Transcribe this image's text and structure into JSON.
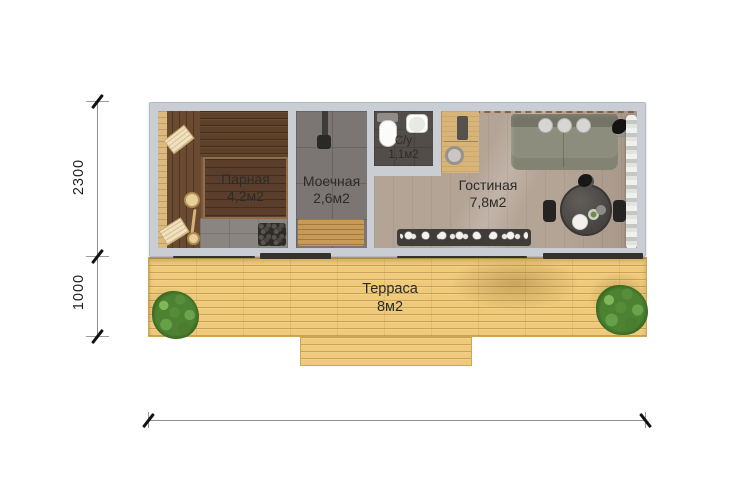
{
  "plan": {
    "title": "Floor plan of sauna house with terrace",
    "rooms": [
      {
        "id": "parnaya",
        "name": "Парная",
        "area": "4,2м2"
      },
      {
        "id": "moechnaya",
        "name": "Моечная",
        "area": "2,6м2"
      },
      {
        "id": "su",
        "name": "С/у",
        "area": "1,1м2"
      },
      {
        "id": "gostinaya",
        "name": "Гостиная",
        "area": "7,8м2"
      },
      {
        "id": "terrasa",
        "name": "Терраса",
        "area": "8м2"
      }
    ],
    "dimensions": {
      "building_depth_mm": "2300",
      "terrace_depth_mm": "1000"
    },
    "colors": {
      "wall": "#c9ced5",
      "terrace_deck": "#eeca7a",
      "sauna_wood": "#5e4129",
      "wet_room_tile": "#7b7673",
      "living_floor": "#b4a496",
      "foliage": "#4d8233",
      "dimension_ink": "#121212"
    }
  }
}
